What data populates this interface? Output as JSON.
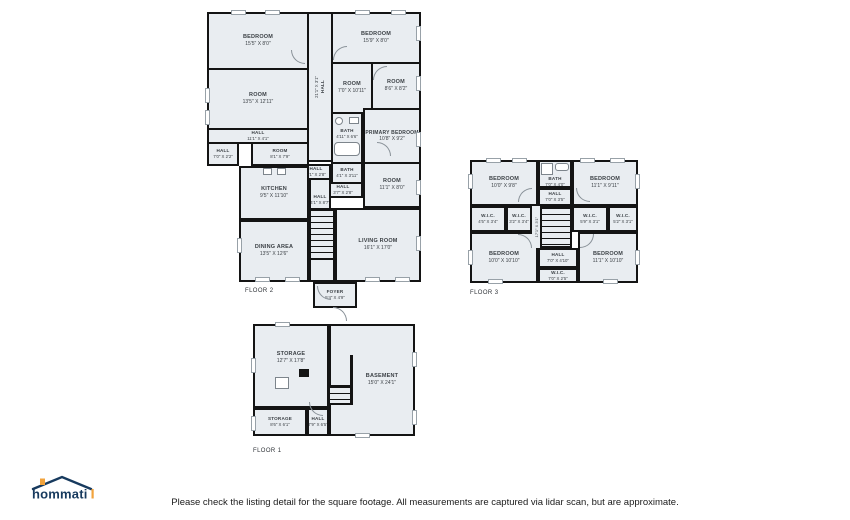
{
  "colors": {
    "floor_fill": "#e9edf1",
    "wall": "#141414",
    "label_text": "#3c4146",
    "logo_navy": "#173a5e",
    "logo_orange": "#f2a33c"
  },
  "footer": {
    "disclaimer": "Please check the listing detail for the square footage. All measurements are captured via lidar scan, but are approximate."
  },
  "logo": {
    "text": "hommati"
  },
  "floor2": {
    "label": "FLOOR 2",
    "rooms": {
      "bedroom_tl": {
        "name": "BEDROOM",
        "size": "15'5\" X 8'0\""
      },
      "hall_v": {
        "name": "HALL",
        "size": "21'1\" X 3'1\""
      },
      "bedroom_tr": {
        "name": "BEDROOM",
        "size": "15'9\" X 8'0\""
      },
      "room_left": {
        "name": "ROOM",
        "size": "13'5\" X 12'11\""
      },
      "room_mid": {
        "name": "ROOM",
        "size": "7'0\" X 10'11\""
      },
      "room_right": {
        "name": "ROOM",
        "size": "8'6\" X 8'2\""
      },
      "hall_a": {
        "name": "HALL",
        "size": "11'1\" X 4'1\""
      },
      "room_small": {
        "name": "ROOM",
        "size": "8'1\" X 7'9\""
      },
      "hall_b": {
        "name": "HALL",
        "size": "7'0\" X 2'2\""
      },
      "bath_upper": {
        "name": "BATH",
        "size": "4'11\" X 6'6\""
      },
      "primary_bedroom": {
        "name": "PRIMARY BEDROOM",
        "size": "10'8\" X 9'2\""
      },
      "hall_c": {
        "name": "HALL",
        "size": "4'1\" X 2'8\""
      },
      "bath_lower": {
        "name": "BATH",
        "size": "4'1\" X 3'11\""
      },
      "room_br": {
        "name": "ROOM",
        "size": "11'1\" X 8'0\""
      },
      "hall_d": {
        "name": "HALL",
        "size": "3'7\" X 2'8\""
      },
      "kitchen": {
        "name": "KITCHEN",
        "size": "9'5\" X 11'10\""
      },
      "hall_e": {
        "name": "HALL",
        "size": "4'1\" X 8'7\""
      },
      "dining": {
        "name": "DINING AREA",
        "size": "13'5\" X 12'6\""
      },
      "living": {
        "name": "LIVING ROOM",
        "size": "16'1\" X 17'0\""
      },
      "foyer": {
        "name": "FOYER",
        "size": "5'4\" X 4'9\""
      }
    }
  },
  "floor3": {
    "label": "FLOOR 3",
    "rooms": {
      "bedroom_tl": {
        "name": "BEDROOM",
        "size": "10'0\" X 9'8\""
      },
      "bath": {
        "name": "BATH",
        "size": "7'0\" X 4'0\""
      },
      "bedroom_tr": {
        "name": "BEDROOM",
        "size": "11'1\" X 9'11\""
      },
      "hall_top": {
        "name": "HALL",
        "size": "7'0\" X 3'5\""
      },
      "wic_a": {
        "name": "W.I.C.",
        "size": "4'5\" X 3'4\""
      },
      "wic_b": {
        "name": "W.I.C.",
        "size": "3'2\" X 3'4\""
      },
      "hall_v": {
        "name": "HALL",
        "size": "17'1\" X 3'1\""
      },
      "wic_c": {
        "name": "W.I.C.",
        "size": "5'9\" X 3'1\""
      },
      "wic_d": {
        "name": "W.I.C.",
        "size": "5'2\" X 3'1\""
      },
      "bedroom_bl": {
        "name": "BEDROOM",
        "size": "10'0\" X 10'10\""
      },
      "hall_bottom": {
        "name": "HALL",
        "size": "7'0\" X 4'10\""
      },
      "wic_e": {
        "name": "W.I.C.",
        "size": "7'0\" X 2'5\""
      },
      "bedroom_br": {
        "name": "BEDROOM",
        "size": "11'1\" X 10'10\""
      }
    }
  },
  "floor1": {
    "label": "FLOOR 1",
    "rooms": {
      "storage_main": {
        "name": "STORAGE",
        "size": "12'7\" X 17'8\""
      },
      "basement": {
        "name": "BASEMENT",
        "size": "15'0\" X 24'1\""
      },
      "storage_small": {
        "name": "STORAGE",
        "size": "8'6\" X 6'1\""
      },
      "hall": {
        "name": "HALL",
        "size": "7'9\" X 6'5\""
      }
    }
  }
}
